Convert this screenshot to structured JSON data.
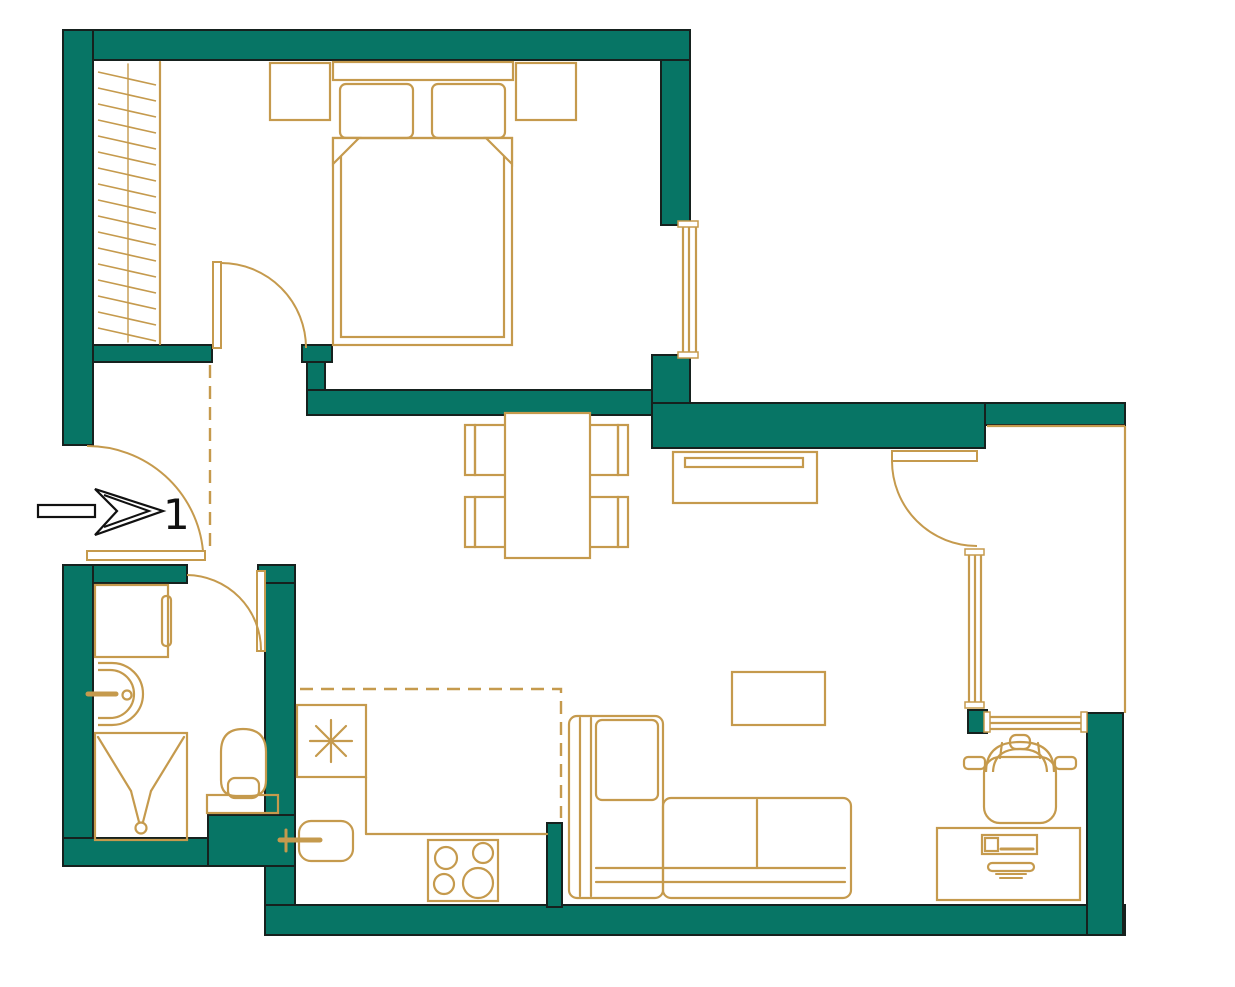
{
  "meta": {
    "drawing_type": "apartment-floor-plan"
  },
  "entrance": {
    "label": "1"
  },
  "colors": {
    "wall": "#077565",
    "outline": "#16211e",
    "furniture": "#C59A4D",
    "arrow": "#111111",
    "background": "#ffffff"
  },
  "plan": {
    "width": 1235,
    "height": 987,
    "walls": [
      {
        "name": "wall-top",
        "x": 63,
        "y": 30,
        "w": 627,
        "h": 30
      },
      {
        "name": "wall-left-upper",
        "x": 63,
        "y": 30,
        "w": 30,
        "h": 415
      },
      {
        "name": "wall-hall-divider",
        "x": 93,
        "y": 345,
        "w": 119,
        "h": 17
      },
      {
        "name": "wall-bedroom-door-block",
        "x": 302,
        "y": 345,
        "w": 30,
        "h": 17
      },
      {
        "name": "wall-bedroom-door-connector",
        "x": 307,
        "y": 362,
        "w": 18,
        "h": 30
      },
      {
        "name": "wall-bedroom-south",
        "x": 307,
        "y": 390,
        "w": 354,
        "h": 25
      },
      {
        "name": "wall-bedroom-right-upper",
        "x": 661,
        "y": 60,
        "w": 29,
        "h": 165
      },
      {
        "name": "wall-bedroom-right-lower",
        "x": 652,
        "y": 355,
        "w": 38,
        "h": 60
      },
      {
        "name": "wall-living-north",
        "x": 652,
        "y": 403,
        "w": 333,
        "h": 45
      },
      {
        "name": "wall-loggia-north",
        "x": 985,
        "y": 403,
        "w": 140,
        "h": 22
      },
      {
        "name": "wall-bath-left",
        "x": 63,
        "y": 565,
        "w": 30,
        "h": 301
      },
      {
        "name": "wall-bath-north-left",
        "x": 93,
        "y": 565,
        "w": 94,
        "h": 18
      },
      {
        "name": "wall-bath-north-right",
        "x": 258,
        "y": 565,
        "w": 37,
        "h": 18
      },
      {
        "name": "wall-bath-right",
        "x": 265,
        "y": 583,
        "w": 30,
        "h": 232
      },
      {
        "name": "wall-bath-south-block",
        "x": 208,
        "y": 815,
        "w": 87,
        "h": 51
      },
      {
        "name": "wall-bath-south",
        "x": 63,
        "y": 838,
        "w": 145,
        "h": 28
      },
      {
        "name": "wall-bottom-connector",
        "x": 265,
        "y": 866,
        "w": 30,
        "h": 69
      },
      {
        "name": "wall-bottom",
        "x": 265,
        "y": 905,
        "w": 860,
        "h": 30
      },
      {
        "name": "wall-kitchen-post",
        "x": 547,
        "y": 823,
        "w": 15,
        "h": 84
      },
      {
        "name": "wall-loggia-window-post",
        "x": 968,
        "y": 710,
        "w": 19,
        "h": 23
      },
      {
        "name": "wall-right-lower",
        "x": 1087,
        "y": 713,
        "w": 36,
        "h": 222
      }
    ],
    "windows": [
      {
        "name": "window-bedroom",
        "lines": [
          [
            683,
            225,
            683,
            355
          ],
          [
            689,
            225,
            689,
            355
          ],
          [
            696,
            225,
            696,
            355
          ]
        ],
        "caps": [
          [
            678,
            221,
            20,
            6
          ],
          [
            678,
            352,
            20,
            6
          ]
        ]
      },
      {
        "name": "window-loggia-west",
        "lines": [
          [
            969,
            553,
            969,
            706
          ],
          [
            975,
            553,
            975,
            706
          ],
          [
            981,
            553,
            981,
            706
          ]
        ],
        "caps": [
          [
            965,
            549,
            19,
            6
          ],
          [
            965,
            702,
            19,
            6
          ]
        ]
      },
      {
        "name": "window-loggia-south",
        "lines": [
          [
            987,
            717,
            1087,
            717
          ],
          [
            987,
            723,
            1087,
            723
          ],
          [
            987,
            729,
            1087,
            729
          ]
        ],
        "caps": [
          [
            984,
            712,
            6,
            20
          ],
          [
            1081,
            712,
            6,
            20
          ]
        ]
      },
      {
        "name": "window-loggia-glazing",
        "lines": [
          [
            1125,
            426,
            1125,
            713
          ],
          [
            987,
            426,
            1125,
            426
          ]
        ],
        "caps": []
      }
    ],
    "doors": [
      {
        "name": "door-entrance",
        "leaf": [
          87,
          551,
          118,
          9
        ],
        "arc": "M 87,446 A 116 116 0 0 1 203,551"
      },
      {
        "name": "door-bedroom",
        "leaf": [
          213,
          262,
          8,
          86
        ],
        "arc": "M 221,263 A 85 85 0 0 1 306,348"
      },
      {
        "name": "door-bathroom",
        "leaf": [
          257,
          571,
          8,
          80
        ],
        "arc": "M 187,575 A 75 75 0 0 1 261,650"
      },
      {
        "name": "door-loggia",
        "leaf": [
          892,
          451,
          85,
          10
        ],
        "arc": "M 892,461 A 85 85 0 0 0 977,546"
      }
    ],
    "zones": [
      {
        "name": "zone-kitchen-boundary",
        "points": "300,689 561,689 561,818"
      },
      {
        "name": "zone-hallway-boundary",
        "points": "210,365 210,548"
      }
    ],
    "furniture": [
      {
        "name": "wardrobe",
        "shapes": [
          {
            "k": "line",
            "p": [
              160,
              62,
              160,
              344
            ]
          },
          {
            "k": "line",
            "p": [
              128,
              64,
              128,
              342
            ],
            "w": 1.4
          },
          {
            "k": "hatch",
            "x1": 98,
            "x2": 156,
            "y0": 72,
            "dy": 16,
            "n": 17,
            "s": 13
          }
        ]
      },
      {
        "name": "double-bed",
        "shapes": [
          {
            "k": "rect",
            "p": [
              333,
              62,
              180,
              18
            ]
          },
          {
            "k": "rect",
            "p": [
              270,
              63,
              60,
              57
            ]
          },
          {
            "k": "rect",
            "p": [
              516,
              63,
              60,
              57
            ]
          },
          {
            "k": "rect",
            "p": [
              340,
              84,
              73,
              54,
              6
            ]
          },
          {
            "k": "rect",
            "p": [
              432,
              84,
              73,
              54,
              6
            ]
          },
          {
            "k": "rect",
            "p": [
              333,
              138,
              179,
              207
            ]
          },
          {
            "k": "rect",
            "p": [
              341,
              138,
              163,
              199
            ]
          },
          {
            "k": "poly",
            "pts": "333,138 359,138 333,164",
            "f": "#ffffff"
          },
          {
            "k": "poly",
            "pts": "512,138 486,138 512,164",
            "f": "#ffffff"
          }
        ]
      },
      {
        "name": "dining-table-with-chairs",
        "shapes": [
          {
            "k": "rect",
            "p": [
              475,
              425,
              47,
              50
            ]
          },
          {
            "k": "rect",
            "p": [
              465,
              425,
              10,
              50
            ]
          },
          {
            "k": "rect",
            "p": [
              571,
              425,
              47,
              50
            ]
          },
          {
            "k": "rect",
            "p": [
              618,
              425,
              10,
              50
            ]
          },
          {
            "k": "rect",
            "p": [
              475,
              497,
              47,
              50
            ]
          },
          {
            "k": "rect",
            "p": [
              465,
              497,
              10,
              50
            ]
          },
          {
            "k": "rect",
            "p": [
              571,
              497,
              47,
              50
            ]
          },
          {
            "k": "rect",
            "p": [
              618,
              497,
              10,
              50
            ]
          },
          {
            "k": "rect",
            "p": [
              505,
              413,
              85,
              145
            ],
            "f": "#ffffff"
          }
        ]
      },
      {
        "name": "tv-console",
        "shapes": [
          {
            "k": "rect",
            "p": [
              673,
              452,
              144,
              51
            ]
          },
          {
            "k": "rect",
            "p": [
              685,
              458,
              118,
              9
            ]
          }
        ]
      },
      {
        "name": "coffee-table",
        "shapes": [
          {
            "k": "rect",
            "p": [
              732,
              672,
              93,
              53
            ]
          }
        ]
      },
      {
        "name": "corner-sofa",
        "shapes": [
          {
            "k": "rect",
            "p": [
              569,
              716,
              94,
              182,
              8
            ]
          },
          {
            "k": "line",
            "p": [
              580,
              718,
              580,
              896
            ]
          },
          {
            "k": "line",
            "p": [
              591,
              718,
              591,
              896
            ]
          },
          {
            "k": "rect",
            "p": [
              596,
              720,
              62,
              80,
              6
            ]
          },
          {
            "k": "rect",
            "p": [
              663,
              798,
              188,
              100,
              8
            ]
          },
          {
            "k": "line",
            "p": [
              757,
              800,
              757,
              868
            ]
          },
          {
            "k": "line",
            "p": [
              596,
              868,
              845,
              868
            ]
          },
          {
            "k": "line",
            "p": [
              596,
              882,
              845,
              882
            ]
          }
        ]
      },
      {
        "name": "desk",
        "shapes": [
          {
            "k": "rect",
            "p": [
              937,
              828,
              143,
              72
            ]
          },
          {
            "k": "rect",
            "p": [
              982,
              835,
              55,
              19
            ]
          },
          {
            "k": "rect",
            "p": [
              985,
              838,
              13,
              13
            ]
          },
          {
            "k": "line",
            "p": [
              1001,
              849,
              1033,
              849
            ],
            "w": 3
          },
          {
            "k": "rect",
            "p": [
              988,
              863,
              46,
              8,
              4
            ]
          },
          {
            "k": "line",
            "p": [
              996,
              874,
              1026,
              874
            ],
            "w": 2
          },
          {
            "k": "line",
            "p": [
              1000,
              878,
              1022,
              878
            ],
            "w": 2
          }
        ]
      },
      {
        "name": "armchair",
        "shapes": [
          {
            "k": "rect",
            "p": [
              984,
              757,
              72,
              66,
              16
            ]
          },
          {
            "k": "path",
            "d": "M 986,772 Q 986,742 1020,742 Q 1054,742 1054,772"
          },
          {
            "k": "path",
            "d": "M 993,772 Q 994,749 1020,749 Q 1046,749 1047,772"
          },
          {
            "k": "line",
            "p": [
              1002,
              743,
              1000,
              758
            ]
          },
          {
            "k": "line",
            "p": [
              1038,
              743,
              1040,
              758
            ]
          },
          {
            "k": "rect",
            "p": [
              1010,
              735,
              20,
              14,
              6
            ]
          },
          {
            "k": "rect",
            "p": [
              964,
              757,
              21,
              12,
              4
            ]
          },
          {
            "k": "rect",
            "p": [
              1055,
              757,
              21,
              12,
              4
            ]
          }
        ]
      },
      {
        "name": "refrigerator",
        "shapes": [
          {
            "k": "rect",
            "p": [
              297,
              705,
              69,
              72
            ]
          },
          {
            "k": "line",
            "p": [
              310,
              741,
              352,
              741
            ]
          },
          {
            "k": "line",
            "p": [
              331,
              720,
              331,
              762
            ]
          },
          {
            "k": "line",
            "p": [
              316,
              726,
              346,
              756
            ]
          },
          {
            "k": "line",
            "p": [
              316,
              756,
              346,
              726
            ]
          }
        ]
      },
      {
        "name": "kitchen-counter",
        "shapes": [
          {
            "k": "line",
            "p": [
              366,
              777,
              366,
              834
            ]
          },
          {
            "k": "line",
            "p": [
              366,
              834,
              547,
              834
            ]
          }
        ]
      },
      {
        "name": "kitchen-sink",
        "shapes": [
          {
            "k": "rect",
            "p": [
              299,
              821,
              54,
              40,
              12
            ]
          },
          {
            "k": "line",
            "p": [
              280,
              840,
              320,
              840
            ],
            "w": 5
          },
          {
            "k": "line",
            "p": [
              286,
              830,
              286,
              851
            ],
            "w": 3
          }
        ]
      },
      {
        "name": "stove",
        "shapes": [
          {
            "k": "rect",
            "p": [
              428,
              840,
              70,
              61
            ]
          },
          {
            "k": "circle",
            "p": [
              446,
              858,
              11
            ]
          },
          {
            "k": "circle",
            "p": [
              483,
              853,
              10
            ]
          },
          {
            "k": "circle",
            "p": [
              444,
              884,
              10
            ]
          },
          {
            "k": "circle",
            "p": [
              478,
              883,
              15
            ]
          }
        ]
      },
      {
        "name": "washing-machine",
        "shapes": [
          {
            "k": "rect",
            "p": [
              95,
              585,
              73,
              72
            ]
          },
          {
            "k": "rect",
            "p": [
              162,
              596,
              9,
              50,
              4
            ]
          }
        ]
      },
      {
        "name": "bathroom-sink",
        "shapes": [
          {
            "k": "path",
            "d": "M 98,663 L 112,663 A 31 31 0 0 1 112,725 L 98,725"
          },
          {
            "k": "path",
            "d": "M 98,670 L 110,670 A 24 24 0 0 1 110,718 L 98,718"
          },
          {
            "k": "line",
            "p": [
              88,
              694,
              116,
              694
            ],
            "w": 5
          },
          {
            "k": "circle",
            "p": [
              127,
              695,
              4.5
            ]
          }
        ]
      },
      {
        "name": "shower",
        "shapes": [
          {
            "k": "rect",
            "p": [
              95,
              733,
              92,
              107
            ]
          },
          {
            "k": "line",
            "p": [
              98,
              737,
              131,
              791
            ]
          },
          {
            "k": "line",
            "p": [
              184,
              737,
              151,
              791
            ]
          },
          {
            "k": "line",
            "p": [
              131,
              791,
              139,
              822
            ]
          },
          {
            "k": "line",
            "p": [
              151,
              791,
              143,
              822
            ]
          },
          {
            "k": "circle",
            "p": [
              141,
              828,
              5.5
            ]
          }
        ]
      },
      {
        "name": "toilet",
        "shapes": [
          {
            "k": "rect",
            "p": [
              207,
              795,
              71,
              18
            ]
          },
          {
            "k": "path",
            "d": "M 221,752 Q 221,729 243,729 Q 266,729 266,752 L 266,780 Q 266,796 251,796 L 236,796 Q 221,796 221,780 Z",
            "f": "#ffffff"
          },
          {
            "k": "rect",
            "p": [
              228,
              778,
              31,
              20,
              7
            ]
          }
        ]
      }
    ],
    "arrow": {
      "shaft": [
        38,
        505,
        57,
        12
      ],
      "head": "163,511 95,489 117,511 95,535",
      "inner": "104,495 149,511 104,527"
    }
  }
}
